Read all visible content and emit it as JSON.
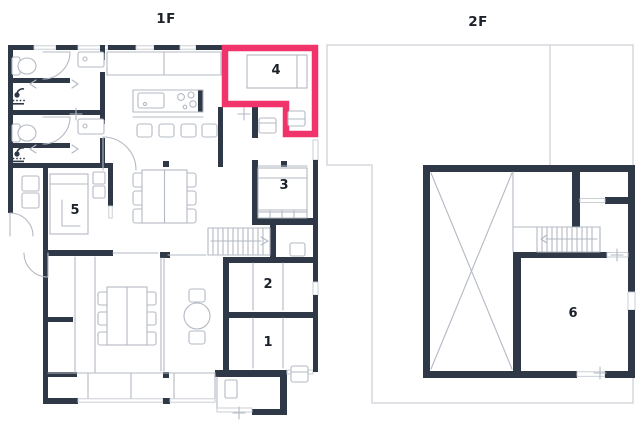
{
  "floors": [
    {
      "label": "1F"
    },
    {
      "label": "2F"
    }
  ],
  "rooms": [
    {
      "number": "1",
      "floor": "1F",
      "highlighted": false
    },
    {
      "number": "2",
      "floor": "1F",
      "highlighted": false
    },
    {
      "number": "3",
      "floor": "1F",
      "highlighted": false
    },
    {
      "number": "4",
      "floor": "1F",
      "highlighted": true
    },
    {
      "number": "5",
      "floor": "1F",
      "highlighted": false
    },
    {
      "number": "6",
      "floor": "2F",
      "highlighted": false
    }
  ],
  "colors": {
    "wall": "#2e3846",
    "fixture_line": "#b3b9c3",
    "footprint_line": "#cdd1d7",
    "highlight": "#f1336b",
    "text": "#1c212a",
    "background": "#ffffff"
  },
  "icons": [
    "toilet-icon",
    "shower-icon",
    "vanity-icon",
    "kitchen-island-icon",
    "stairs-icon",
    "bed-icon",
    "dining-table-icon",
    "round-table-icon",
    "door-arc-icon",
    "void-cross-icon",
    "arrow-right-icon",
    "arrow-left-icon"
  ]
}
